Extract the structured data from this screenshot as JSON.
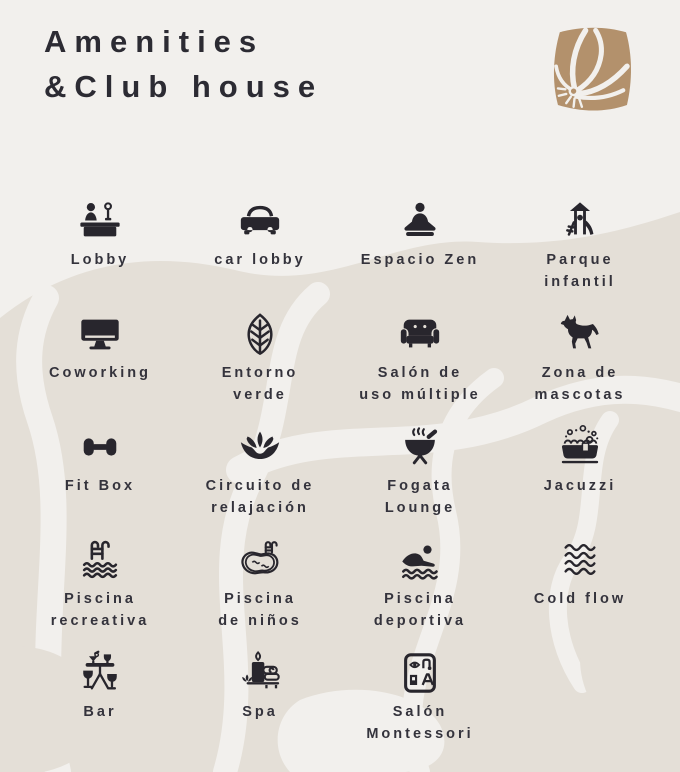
{
  "header": {
    "title_line1": "Amenities",
    "title_line2": "&Club house"
  },
  "logo": {
    "name": "flower-logo"
  },
  "colors": {
    "background": "#f2f0ed",
    "blob_beige": "#e4dfd7",
    "title_text": "#2c2b33",
    "label_text": "#34333c",
    "icon": "#28262d",
    "logo_tan": "#b3916c"
  },
  "amenities": [
    {
      "icon": "reception-desk-icon",
      "lines": [
        "Lobby"
      ]
    },
    {
      "icon": "car-icon",
      "lines": [
        "car lobby"
      ]
    },
    {
      "icon": "meditation-icon",
      "lines": [
        "Espacio Zen"
      ]
    },
    {
      "icon": "playground-icon",
      "lines": [
        "Parque",
        "infantil"
      ]
    },
    {
      "icon": "monitor-icon",
      "lines": [
        "Coworking"
      ]
    },
    {
      "icon": "leaf-icon",
      "lines": [
        "Entorno",
        "verde"
      ]
    },
    {
      "icon": "sofa-icon",
      "lines": [
        "Salón de",
        "uso múltiple"
      ]
    },
    {
      "icon": "dog-icon",
      "lines": [
        "Zona de",
        "mascotas"
      ]
    },
    {
      "icon": "dumbbell-icon",
      "lines": [
        "Fit Box"
      ]
    },
    {
      "icon": "lotus-icon",
      "lines": [
        "Circuito de",
        "relajación"
      ]
    },
    {
      "icon": "grill-icon",
      "lines": [
        "Fogata",
        "Lounge"
      ]
    },
    {
      "icon": "hot-tub-icon",
      "lines": [
        "Jacuzzi"
      ]
    },
    {
      "icon": "pool-ladder-icon",
      "lines": [
        "Piscina",
        "recreativa"
      ]
    },
    {
      "icon": "kids-pool-icon",
      "lines": [
        "Piscina",
        "de niños"
      ]
    },
    {
      "icon": "swimmer-icon",
      "lines": [
        "Piscina",
        "deportiva"
      ]
    },
    {
      "icon": "waves-icon",
      "lines": [
        "Cold flow"
      ]
    },
    {
      "icon": "bar-table-icon",
      "lines": [
        "Bar"
      ]
    },
    {
      "icon": "spa-candle-icon",
      "lines": [
        "Spa"
      ]
    },
    {
      "icon": "montessori-icon",
      "lines": [
        "Salón",
        "Montessori"
      ]
    }
  ]
}
